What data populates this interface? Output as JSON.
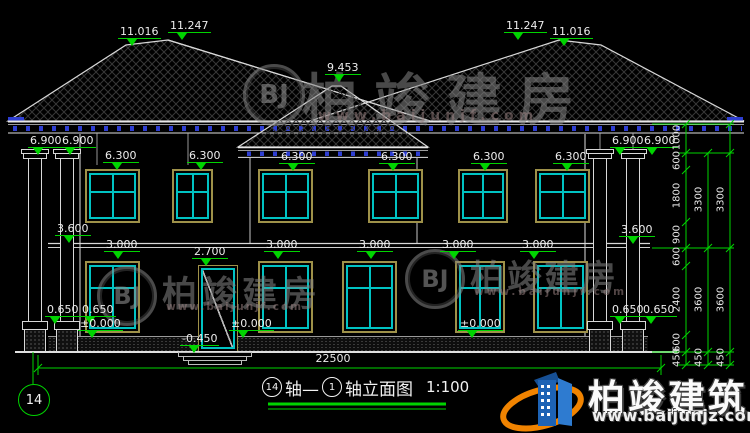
{
  "title": {
    "axis_from": "14",
    "axis_word": "轴—",
    "axis_to": "1",
    "suffix": "轴立面图",
    "scale": "1:100"
  },
  "axis_bubble": "14",
  "levels": {
    "ridge_left_outer": "11.016",
    "ridge_left_inner": "11.247",
    "porch_peak": "9.453",
    "ridge_right_inner": "11.247",
    "ridge_right_outer": "11.016",
    "eave": [
      "6.900",
      "6.900",
      "6.900",
      "6.900"
    ],
    "floor2_windows": [
      "6.300",
      "6.300",
      "6.300",
      "6.300",
      "6.300",
      "6.300"
    ],
    "mid_band": [
      "3.600",
      "3.600"
    ],
    "floor1_windows": [
      "3.000",
      "3.000",
      "3.000",
      "3.000",
      "3.000"
    ],
    "door_top": "2.700",
    "column_base": [
      "0.650",
      "0.650",
      "0.650",
      "0.650"
    ],
    "ground": [
      "±0.000",
      "±0.000",
      "±0.000"
    ],
    "entry_step": "-0.450"
  },
  "dims": {
    "total_width": "22500",
    "chain_inner": [
      "1000",
      "600",
      "1800",
      "900",
      "600",
      "2400",
      "600",
      "450"
    ],
    "chain_mid": [
      "3300",
      "3600",
      "450"
    ],
    "chain_outer": [
      "3300",
      "3600",
      "450"
    ]
  },
  "watermarks": {
    "monogram": "BJ",
    "name": "柏竣建房",
    "url": "www.baijunjf.com"
  },
  "brand": {
    "name": "柏竣建筑",
    "url": "www.baijunjz.com"
  }
}
